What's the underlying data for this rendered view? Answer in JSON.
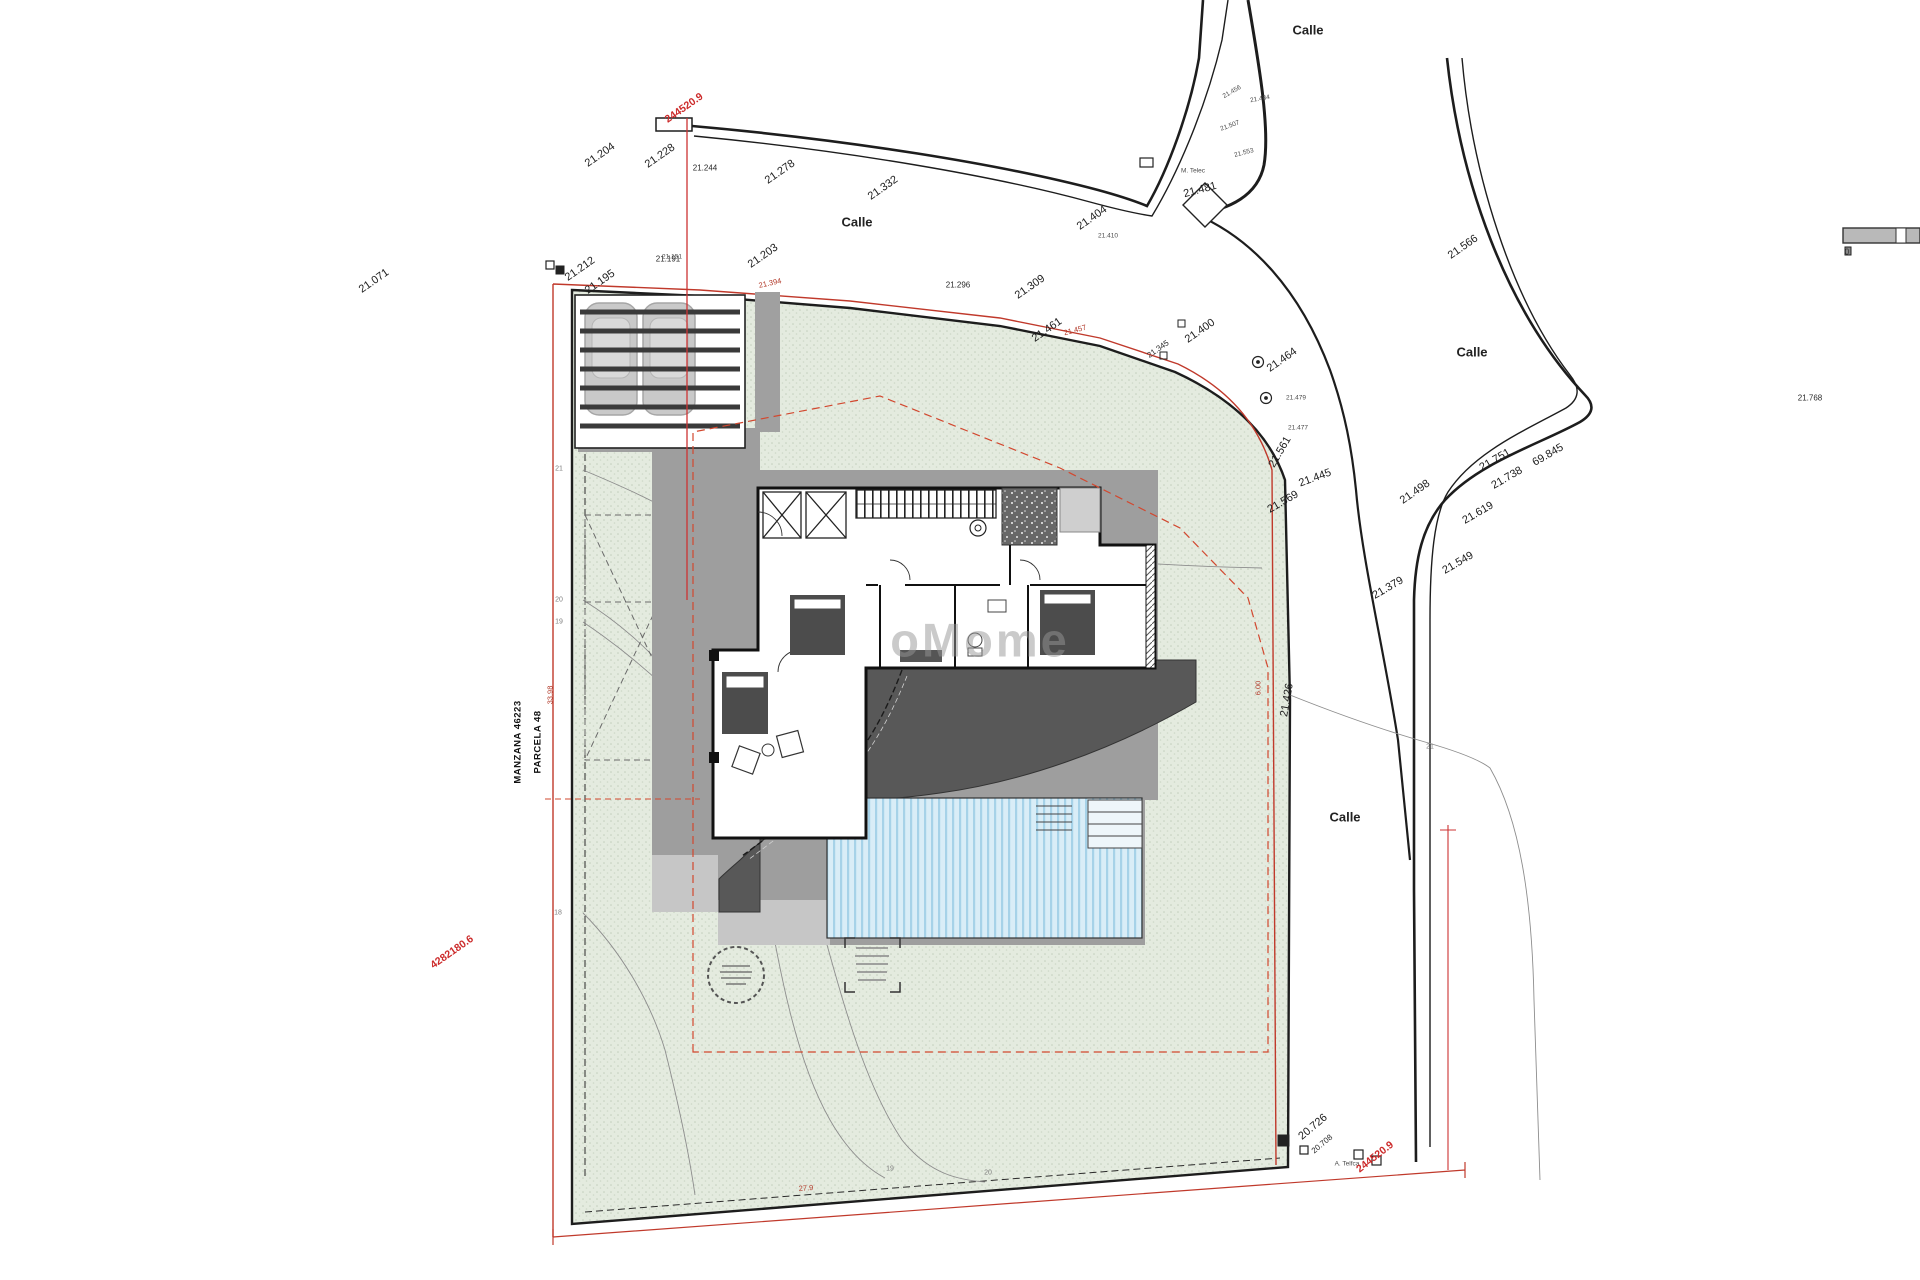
{
  "drawing_title": "Site plan - villa parcel",
  "parcel": {
    "block": "MANZANA 46223",
    "plot": "PARCELA 48"
  },
  "watermark": "oMome",
  "scalebar": {
    "zero_label": "0"
  },
  "labels": [
    {
      "text": "Calle",
      "x": 857,
      "y": 222,
      "rot": 0,
      "cls": "st",
      "name": "street-label"
    },
    {
      "text": "Calle",
      "x": 1308,
      "y": 30,
      "rot": 0,
      "cls": "st",
      "name": "street-label"
    },
    {
      "text": "Calle",
      "x": 1472,
      "y": 352,
      "rot": 0,
      "cls": "st",
      "name": "street-label"
    },
    {
      "text": "Calle",
      "x": 1345,
      "y": 817,
      "rot": 0,
      "cls": "st",
      "name": "street-label"
    },
    {
      "text": "21.071",
      "x": 374,
      "y": 281,
      "rot": -35,
      "cls": "e",
      "name": "elevation-label"
    },
    {
      "text": "21.204",
      "x": 600,
      "y": 155,
      "rot": -35,
      "cls": "e",
      "name": "elevation-label"
    },
    {
      "text": "21.228",
      "x": 660,
      "y": 156,
      "rot": -35,
      "cls": "e",
      "name": "elevation-label"
    },
    {
      "text": "21.244",
      "x": 705,
      "y": 168,
      "rot": 0,
      "cls": "es",
      "name": "elevation-label"
    },
    {
      "text": "21.278",
      "x": 780,
      "y": 172,
      "rot": -35,
      "cls": "e",
      "name": "elevation-label"
    },
    {
      "text": "21.332",
      "x": 883,
      "y": 188,
      "rot": -35,
      "cls": "e",
      "name": "elevation-label"
    },
    {
      "text": "21.404",
      "x": 1092,
      "y": 218,
      "rot": -35,
      "cls": "e",
      "name": "elevation-label"
    },
    {
      "text": "21.410",
      "x": 1108,
      "y": 236,
      "rot": 0,
      "cls": "ex",
      "name": "elevation-label"
    },
    {
      "text": "21.481",
      "x": 1200,
      "y": 190,
      "rot": -15,
      "cls": "e",
      "name": "elevation-label"
    },
    {
      "text": "21.456",
      "x": 1232,
      "y": 92,
      "rot": -30,
      "cls": "ex",
      "name": "elevation-label"
    },
    {
      "text": "21.484",
      "x": 1260,
      "y": 99,
      "rot": -10,
      "cls": "ex",
      "name": "elevation-label"
    },
    {
      "text": "21.507",
      "x": 1230,
      "y": 126,
      "rot": -20,
      "cls": "ex",
      "name": "elevation-label"
    },
    {
      "text": "21.553",
      "x": 1244,
      "y": 153,
      "rot": -15,
      "cls": "ex",
      "name": "elevation-label"
    },
    {
      "text": "M. Telec",
      "x": 1193,
      "y": 171,
      "rot": 0,
      "cls": "ex",
      "name": "utility-label"
    },
    {
      "text": "21.212",
      "x": 580,
      "y": 269,
      "rot": -35,
      "cls": "e",
      "name": "elevation-label"
    },
    {
      "text": "21.195",
      "x": 600,
      "y": 282,
      "rot": -35,
      "cls": "e",
      "name": "elevation-label"
    },
    {
      "text": "21.151",
      "x": 672,
      "y": 257,
      "rot": 0,
      "cls": "ex",
      "name": "elevation-label"
    },
    {
      "text": "21.191",
      "x": 668,
      "y": 259,
      "rot": 0,
      "cls": "es",
      "name": "elevation-label"
    },
    {
      "text": "21.203",
      "x": 763,
      "y": 256,
      "rot": -35,
      "cls": "e",
      "name": "elevation-label"
    },
    {
      "text": "21.296",
      "x": 958,
      "y": 285,
      "rot": 0,
      "cls": "es",
      "name": "elevation-label"
    },
    {
      "text": "21.309",
      "x": 1030,
      "y": 287,
      "rot": -35,
      "cls": "e",
      "name": "elevation-label"
    },
    {
      "text": "21.461",
      "x": 1047,
      "y": 330,
      "rot": -35,
      "cls": "e",
      "name": "elevation-label"
    },
    {
      "text": "21.394",
      "x": 770,
      "y": 283,
      "rot": -12,
      "cls": "rs",
      "name": "dimension-label"
    },
    {
      "text": "21.457",
      "x": 1075,
      "y": 330,
      "rot": -15,
      "cls": "rs",
      "name": "dimension-label"
    },
    {
      "text": "21.345",
      "x": 1158,
      "y": 349,
      "rot": -35,
      "cls": "es",
      "name": "elevation-label"
    },
    {
      "text": "21.400",
      "x": 1200,
      "y": 331,
      "rot": -35,
      "cls": "e",
      "name": "elevation-label"
    },
    {
      "text": "21.464",
      "x": 1282,
      "y": 360,
      "rot": -35,
      "cls": "e",
      "name": "elevation-label"
    },
    {
      "text": "21.479",
      "x": 1296,
      "y": 398,
      "rot": 0,
      "cls": "ex",
      "name": "elevation-label"
    },
    {
      "text": "21.477",
      "x": 1298,
      "y": 428,
      "rot": 0,
      "cls": "ex",
      "name": "elevation-label"
    },
    {
      "text": "21.561",
      "x": 1280,
      "y": 452,
      "rot": -60,
      "cls": "e",
      "name": "elevation-label"
    },
    {
      "text": "21.445",
      "x": 1315,
      "y": 478,
      "rot": -20,
      "cls": "e",
      "name": "elevation-label"
    },
    {
      "text": "21.569",
      "x": 1283,
      "y": 502,
      "rot": -30,
      "cls": "e",
      "name": "elevation-label"
    },
    {
      "text": "21.426",
      "x": 1287,
      "y": 700,
      "rot": -80,
      "cls": "e",
      "name": "elevation-label"
    },
    {
      "text": "21.566",
      "x": 1463,
      "y": 247,
      "rot": -35,
      "cls": "e",
      "name": "elevation-label"
    },
    {
      "text": "21.768",
      "x": 1810,
      "y": 398,
      "rot": 0,
      "cls": "es",
      "name": "elevation-label"
    },
    {
      "text": "21.498",
      "x": 1415,
      "y": 492,
      "rot": -35,
      "cls": "e",
      "name": "elevation-label"
    },
    {
      "text": "21.751",
      "x": 1495,
      "y": 460,
      "rot": -30,
      "cls": "e",
      "name": "elevation-label"
    },
    {
      "text": "21.738",
      "x": 1507,
      "y": 478,
      "rot": -30,
      "cls": "e",
      "name": "elevation-label"
    },
    {
      "text": "69.845",
      "x": 1548,
      "y": 455,
      "rot": -30,
      "cls": "e",
      "name": "elevation-label"
    },
    {
      "text": "21.619",
      "x": 1478,
      "y": 513,
      "rot": -30,
      "cls": "e",
      "name": "elevation-label"
    },
    {
      "text": "21.549",
      "x": 1458,
      "y": 563,
      "rot": -30,
      "cls": "e",
      "name": "elevation-label"
    },
    {
      "text": "21.379",
      "x": 1388,
      "y": 588,
      "rot": -30,
      "cls": "e",
      "name": "elevation-label"
    },
    {
      "text": "20.726",
      "x": 1313,
      "y": 1127,
      "rot": -40,
      "cls": "e",
      "name": "elevation-label"
    },
    {
      "text": "20.708",
      "x": 1322,
      "y": 1144,
      "rot": -40,
      "cls": "es",
      "name": "elevation-label"
    },
    {
      "text": "A. Telfca",
      "x": 1347,
      "y": 1164,
      "rot": 0,
      "cls": "ex",
      "name": "utility-label"
    },
    {
      "text": "244520.9",
      "x": 684,
      "y": 108,
      "rot": -35,
      "cls": "r",
      "name": "coordinate-label"
    },
    {
      "text": "4282180.6",
      "x": 452,
      "y": 952,
      "rot": -35,
      "cls": "r",
      "name": "coordinate-label"
    },
    {
      "text": "244520.9",
      "x": 1375,
      "y": 1157,
      "rot": -38,
      "cls": "r",
      "name": "coordinate-label"
    },
    {
      "text": "33.98",
      "x": 550,
      "y": 695,
      "rot": -90,
      "cls": "rs",
      "name": "dimension-label"
    },
    {
      "text": "27.9",
      "x": 806,
      "y": 1188,
      "rot": -4,
      "cls": "rs",
      "name": "dimension-label"
    },
    {
      "text": "6.00",
      "x": 1258,
      "y": 688,
      "rot": -90,
      "cls": "rs",
      "name": "dimension-label"
    },
    {
      "text": "21",
      "x": 559,
      "y": 469,
      "rot": 0,
      "cls": "cg",
      "name": "contour-label"
    },
    {
      "text": "20",
      "x": 559,
      "y": 600,
      "rot": 0,
      "cls": "cg",
      "name": "contour-label"
    },
    {
      "text": "19",
      "x": 559,
      "y": 622,
      "rot": 0,
      "cls": "cg",
      "name": "contour-label"
    },
    {
      "text": "18",
      "x": 558,
      "y": 913,
      "rot": 0,
      "cls": "cg",
      "name": "contour-label"
    },
    {
      "text": "19",
      "x": 890,
      "y": 1169,
      "rot": 0,
      "cls": "cg",
      "name": "contour-label"
    },
    {
      "text": "20",
      "x": 988,
      "y": 1173,
      "rot": 0,
      "cls": "cg",
      "name": "contour-label"
    },
    {
      "text": "21",
      "x": 1430,
      "y": 747,
      "rot": 0,
      "cls": "cg",
      "name": "contour-label"
    }
  ]
}
